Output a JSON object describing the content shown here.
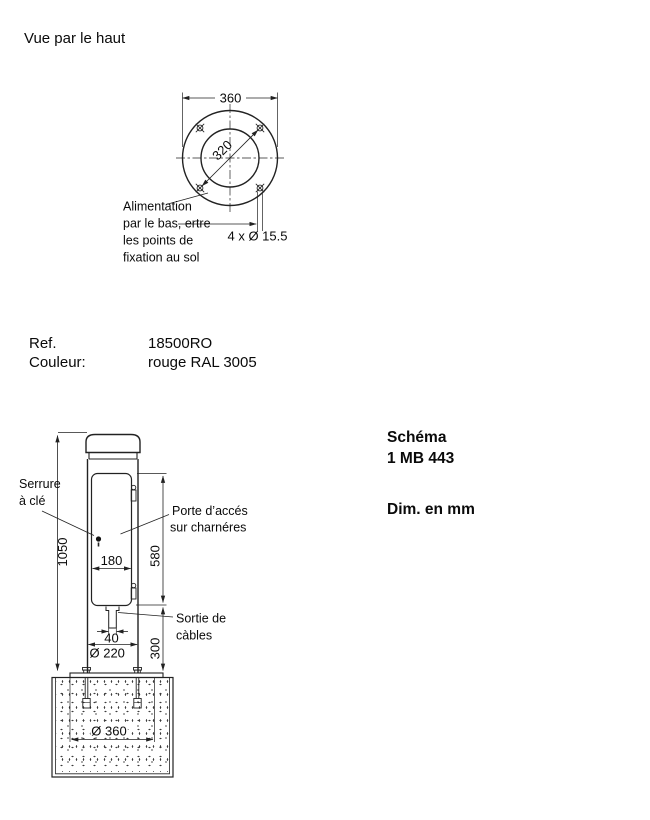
{
  "title": "Vue par le haut",
  "top_view": {
    "dim_outer": "360",
    "dim_bolt_circle": "320",
    "dim_holes": "4 x Ø 15.5",
    "note_line1": "Alimentation",
    "note_line2": "par le bas, ertre",
    "note_line3": "les points de",
    "note_line4": "fixation au sol"
  },
  "info": {
    "ref_label": "Ref.",
    "ref_value": "18500RO",
    "color_label": "Couleur:",
    "color_value": "rouge RAL 3005"
  },
  "schema": {
    "title": "Schéma",
    "number": "1 MB 443",
    "units": "Dim. en mm"
  },
  "side_view": {
    "dim_total_height": "1050",
    "dim_door_height": "580",
    "dim_below_door": "300",
    "dim_door_width": "180",
    "dim_cable_outlet": "40",
    "dim_body_diameter": "Ø 220",
    "dim_foundation_diameter": "Ø 360",
    "lock_label_line1": "Serrure",
    "lock_label_line2": "à clé",
    "door_label_line1": "Porte d’accés",
    "door_label_line2": "sur charnéres",
    "cable_label_line1": "Sortie de",
    "cable_label_line2": "càbles"
  },
  "colors": {
    "line": "#222222",
    "text": "#0a0a0a",
    "background": "#ffffff"
  }
}
